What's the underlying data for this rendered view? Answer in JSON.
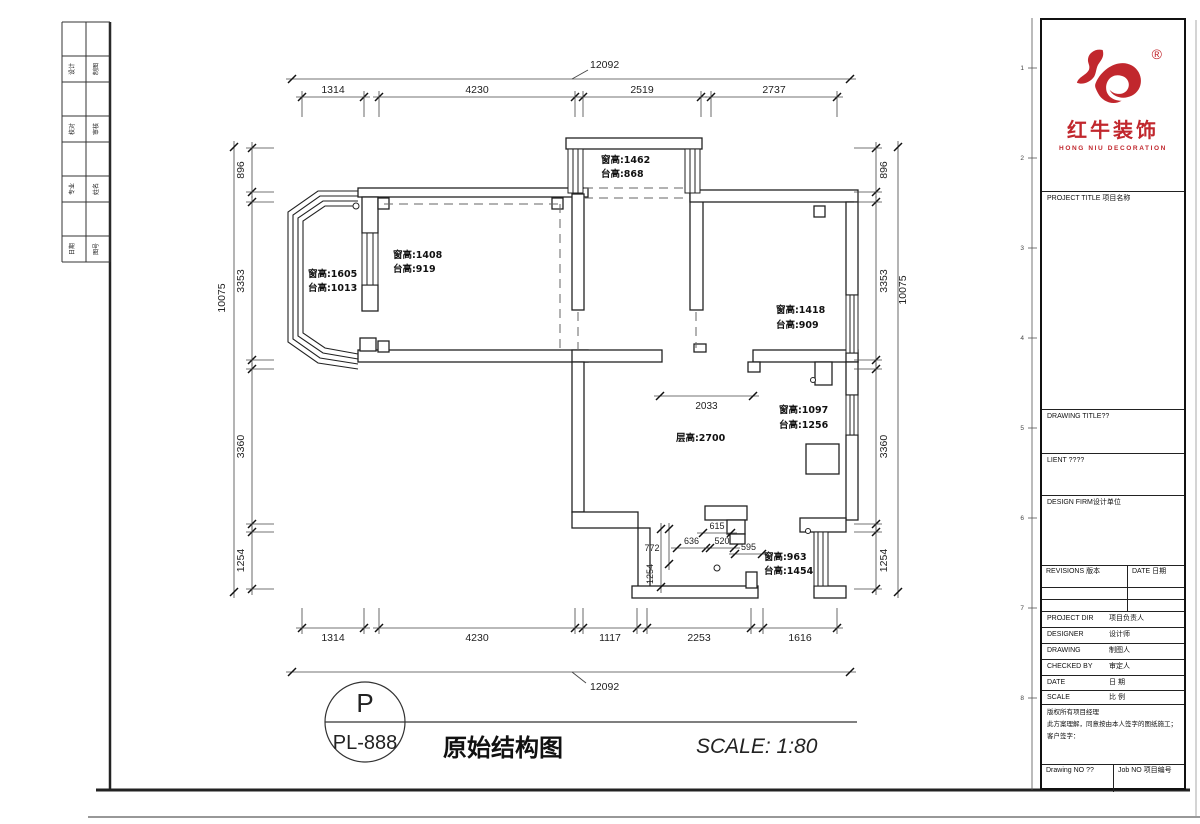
{
  "frame": {
    "strip_labels": [
      "设计",
      "制图",
      "校对",
      "审核",
      "专业",
      "姓名",
      "日期",
      "图号"
    ],
    "fold_marks": [
      "1",
      "2",
      "3",
      "4",
      "5",
      "6",
      "7",
      "8"
    ]
  },
  "plan": {
    "dims": {
      "top": {
        "overall": "12092",
        "segments": [
          "1314",
          "4230",
          "2519",
          "2737"
        ]
      },
      "bottom": {
        "overall": "12092",
        "segments": [
          "1314",
          "4230",
          "1117",
          "2253",
          "1616"
        ]
      },
      "left": {
        "overall": "10075",
        "segments": [
          "896",
          "3353",
          "3360",
          "1254"
        ]
      },
      "right": {
        "overall": "10075",
        "segments": [
          "896",
          "3353",
          "3360",
          "1254"
        ]
      },
      "inner": {
        "opening": "2033",
        "ceiling_height": "层高:2700",
        "seg_615": "615",
        "seg_636": "636",
        "seg_520": "520",
        "seg_595": "595",
        "seg_772": "772",
        "seg_1254": "1254"
      }
    },
    "window_notes": [
      {
        "l1": "窗高:1462",
        "l2": "台高:868"
      },
      {
        "l1": "窗高:1605",
        "l2": "台高:1013"
      },
      {
        "l1": "窗高:1408",
        "l2": "台高:919"
      },
      {
        "l1": "窗高:1418",
        "l2": "台高:909"
      },
      {
        "l1": "窗高:1097",
        "l2": "台高:1256"
      },
      {
        "l1": "窗高:963",
        "l2": "台高:1454"
      }
    ]
  },
  "footer": {
    "badge_letter": "P",
    "badge_code": "PL-888",
    "drawing_title": "原始结构图",
    "scale_note": "SCALE: 1:80"
  },
  "titleblock": {
    "brand": {
      "name_cn": "红牛装饰",
      "name_en": "HONG NIU DECORATION",
      "registered": "®",
      "color": "#c1272d"
    },
    "project_title": "PROJECT TITLE 项目名称",
    "drawing_title": "DRAWING TITLE??",
    "client": "LIENT ????",
    "design_firm": "DESIGN FIRM设计单位",
    "revisions": {
      "col1": "REVISIONS 版本",
      "col2": "DATE 日期"
    },
    "rows": [
      {
        "en": "PROJECT DIR",
        "cn": "项目负责人"
      },
      {
        "en": "DESIGNER",
        "cn": "设计师"
      },
      {
        "en": "DRAWING",
        "cn": "制图人"
      },
      {
        "en": "CHECKED BY",
        "cn": "审定人"
      },
      {
        "en": "DATE",
        "cn": "日 期"
      },
      {
        "en": "SCALE",
        "cn": "比 例"
      }
    ],
    "notes": [
      "版权所有项目经理",
      "此方案理解，同意按由本人签字的图纸施工；",
      "客户签字："
    ],
    "footer": {
      "drawing_no": "Drawing NO ??",
      "job_no": "Job NO 项目编号"
    }
  }
}
